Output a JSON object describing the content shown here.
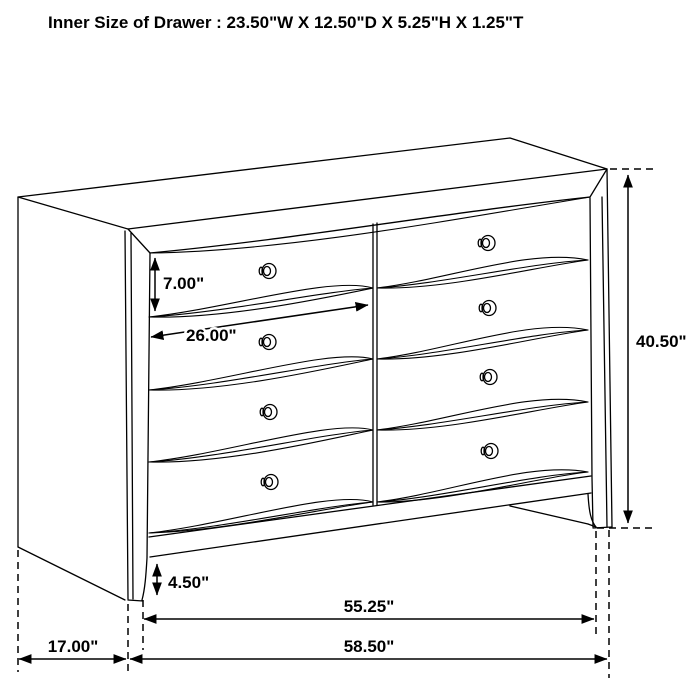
{
  "page": {
    "title": "Inner Size of Drawer : 23.50\"W X 12.50\"D X 5.25\"H X 1.25\"T",
    "background_color": "#ffffff",
    "line_color": "#000000"
  },
  "diagram": {
    "type": "furniture dimension line drawing",
    "subject": "dresser with 8 drawer fronts (4 rows x 2 columns) and 8 knobs",
    "labels": {
      "drawer_face_height": "7.00\"",
      "drawer_opening_width": "26.00\"",
      "overall_height": "40.50\"",
      "foot_height": "4.50\"",
      "front_width": "55.25\"",
      "side_depth": "17.00\"",
      "overall_width": "58.50\""
    }
  }
}
